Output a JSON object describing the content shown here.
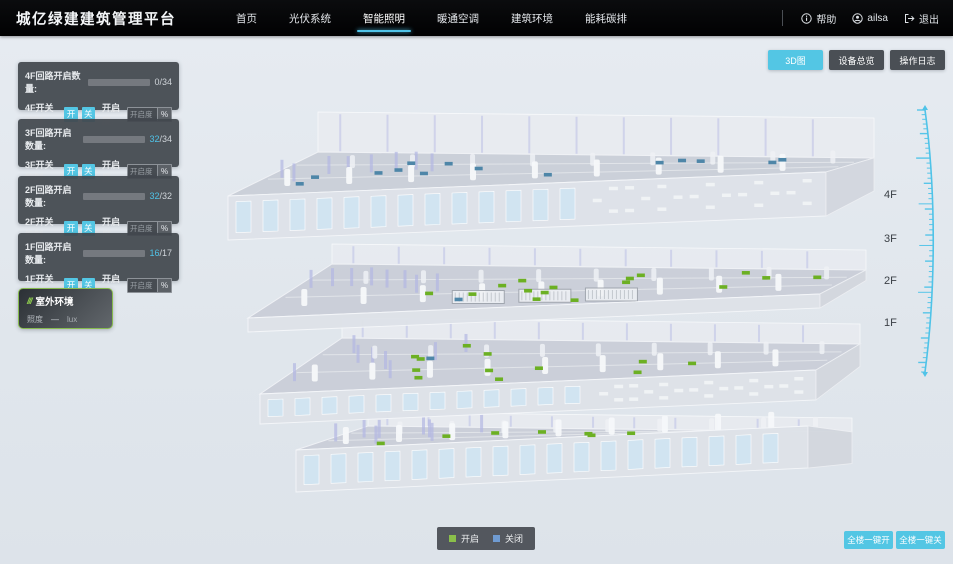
{
  "header": {
    "title": "城亿绿建建筑管理平台",
    "nav": [
      {
        "label": "首页"
      },
      {
        "label": "光伏系统"
      },
      {
        "label": "智能照明"
      },
      {
        "label": "暖通空调"
      },
      {
        "label": "建筑环境"
      },
      {
        "label": "能耗碳排"
      }
    ],
    "active_nav": "智能照明",
    "help_label": "帮助",
    "user_name": "ailsa",
    "logout_label": "退出"
  },
  "view_buttons": [
    {
      "label": "3D图",
      "active": true
    },
    {
      "label": "设备总览",
      "active": false
    },
    {
      "label": "操作日志",
      "active": false
    }
  ],
  "controls": {
    "on_label": "开",
    "off_label": "关",
    "dim_label": "开启度:",
    "dim_placeholder": "开启度",
    "percent_label": "%"
  },
  "floor_panels": [
    {
      "circuit_label": "4F回路开启数量:",
      "open": "0",
      "total": "/34",
      "progress": 0,
      "switch_label": "4F开关控制:"
    },
    {
      "circuit_label": "3F回路开启数量:",
      "open": "32",
      "total": "/34",
      "progress": 0.94,
      "switch_label": "3F开关控制:"
    },
    {
      "circuit_label": "2F回路开启数量:",
      "open": "32",
      "total": "/32",
      "progress": 1,
      "switch_label": "2F开关控制:"
    },
    {
      "circuit_label": "1F回路开启数量:",
      "open": "16",
      "total": "/17",
      "progress": 0.94,
      "switch_label": "1F开关控制:"
    }
  ],
  "outdoor_panel": {
    "title": "室外环境",
    "metric_label": "照度",
    "metric_value": "—",
    "metric_unit": "lux"
  },
  "floor_labels": [
    "4F",
    "3F",
    "2F",
    "1F"
  ],
  "legend": {
    "on_label": "开启",
    "off_label": "关闭",
    "on_color": "#8abf4a",
    "off_color": "#6f9bd2"
  },
  "bulk_buttons": [
    {
      "label": "全楼一键开"
    },
    {
      "label": "全楼一键关"
    }
  ],
  "building": {
    "floors": [
      {
        "name": "4F",
        "on_count": 0,
        "off_count": 14
      },
      {
        "name": "3F",
        "on_count": 16,
        "off_count": 1
      },
      {
        "name": "2F",
        "on_count": 12,
        "off_count": 1
      },
      {
        "name": "1F",
        "on_count": 7,
        "off_count": 0
      }
    ],
    "on_color": "#6cb023",
    "off_color": "#4e86a8",
    "accent_color": "#4fc3e8"
  }
}
